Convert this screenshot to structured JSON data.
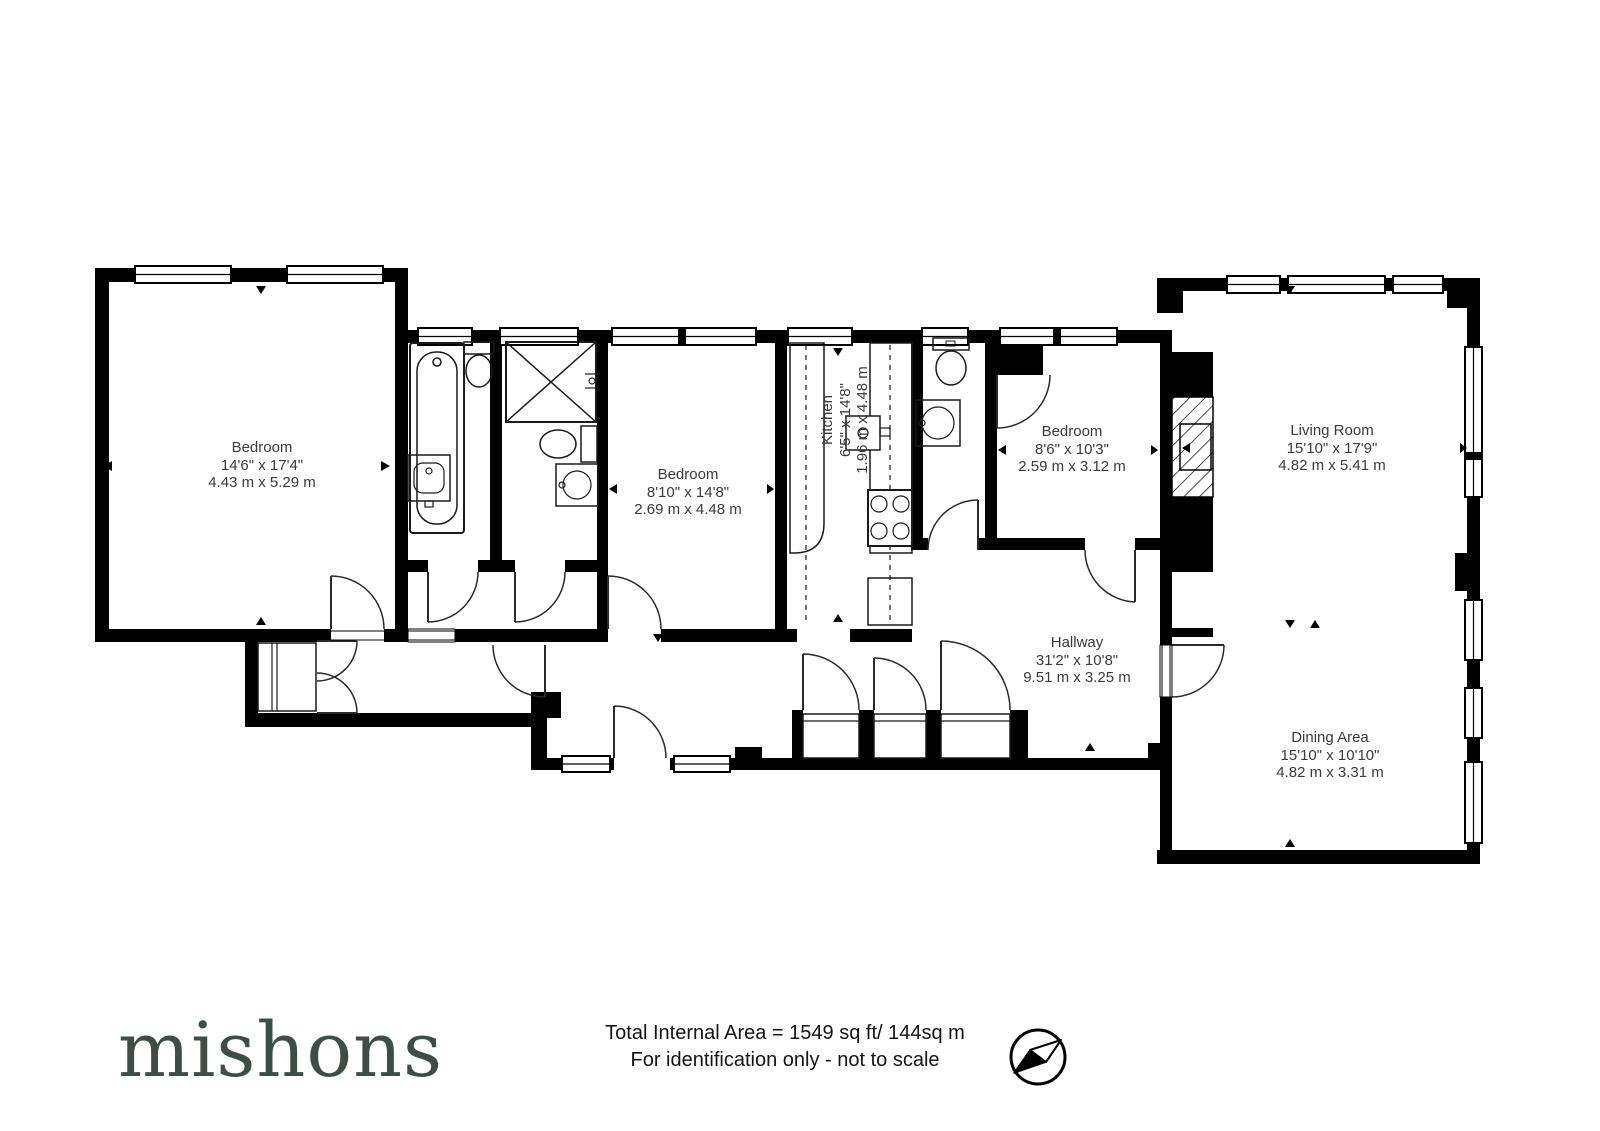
{
  "rooms": [
    {
      "name": "Bedroom",
      "imperial": "14'6\" x 17'4\"",
      "metric": "4.43 m x 5.29 m"
    },
    {
      "name": "Bedroom",
      "imperial": "8'10\" x 14'8\"",
      "metric": "2.69 m x 4.48 m"
    },
    {
      "name": "Kitchen",
      "imperial": "6'5\" x 14'8\"",
      "metric": "1.96 m x 4.48 m"
    },
    {
      "name": "Bedroom",
      "imperial": "8'6\" x 10'3\"",
      "metric": "2.59 m x 3.12 m"
    },
    {
      "name": "Living Room",
      "imperial": "15'10\" x 17'9\"",
      "metric": "4.82 m x 5.41 m"
    },
    {
      "name": "Hallway",
      "imperial": "31'2\" x 10'8\"",
      "metric": "9.51 m x 3.25 m"
    },
    {
      "name": "Dining Area",
      "imperial": "15'10\" x 10'10\"",
      "metric": "4.82 m x 3.31 m"
    }
  ],
  "footer": {
    "brand": "mishons",
    "area_line": "Total Internal Area = 1549 sq ft/ 144sq m",
    "disclaimer": "For identification only - not to scale"
  },
  "colors": {
    "walls": "#000000",
    "brand": "#3e4e46",
    "label_text": "#3b3b3b"
  }
}
